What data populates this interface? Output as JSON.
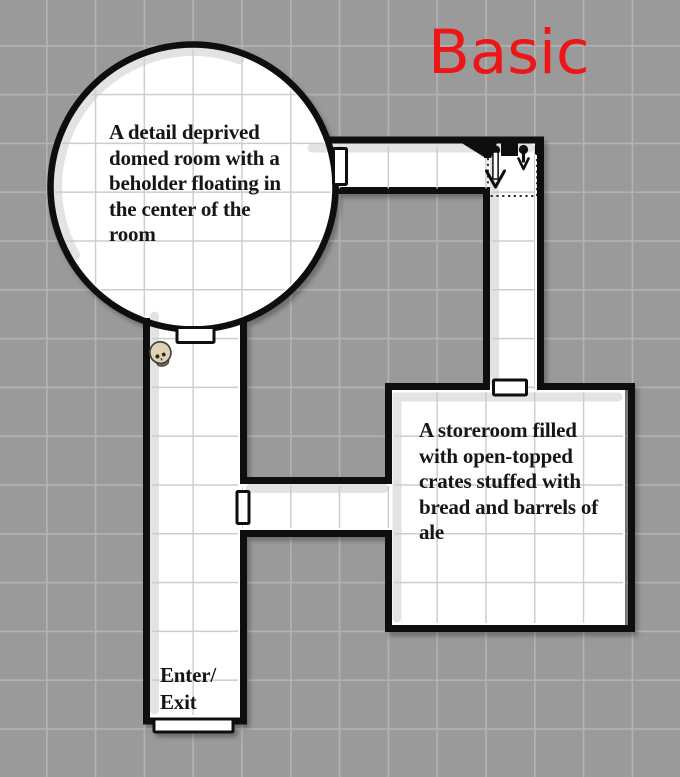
{
  "title": {
    "text": "Basic",
    "color": "#ed1515"
  },
  "map": {
    "background_color": "#9a9a9a",
    "background_grid_color": "#b3b3b3",
    "floor_color": "#ffffff",
    "floor_grid_color": "#cdcdcd",
    "wall_color": "#0e0e0e",
    "rooms": [
      {
        "id": "domed-room",
        "shape": "circle",
        "description": "A detail deprived domed room with a beholder floating in the center of the room",
        "description_lines": [
          "A detail deprived",
          "domed room with a",
          "beholder floating in",
          "the center of the",
          "room"
        ]
      },
      {
        "id": "storeroom",
        "shape": "rectangle",
        "description": "A storeroom filled with open-topped crates stuffed with bread and barrels of ale",
        "description_lines": [
          "A storeroom filled",
          "with open-topped",
          "crates stuffed with",
          "bread and barrels of",
          "ale"
        ]
      }
    ],
    "entrance": {
      "label": "Enter/Exit",
      "label_lines": [
        "Enter/",
        "Exit"
      ]
    },
    "doors_count": 5,
    "icons": [
      {
        "name": "skull-icon",
        "color": "#ded3b4"
      },
      {
        "name": "stairs-down-icon",
        "meaning": "stairs leading down"
      }
    ]
  }
}
